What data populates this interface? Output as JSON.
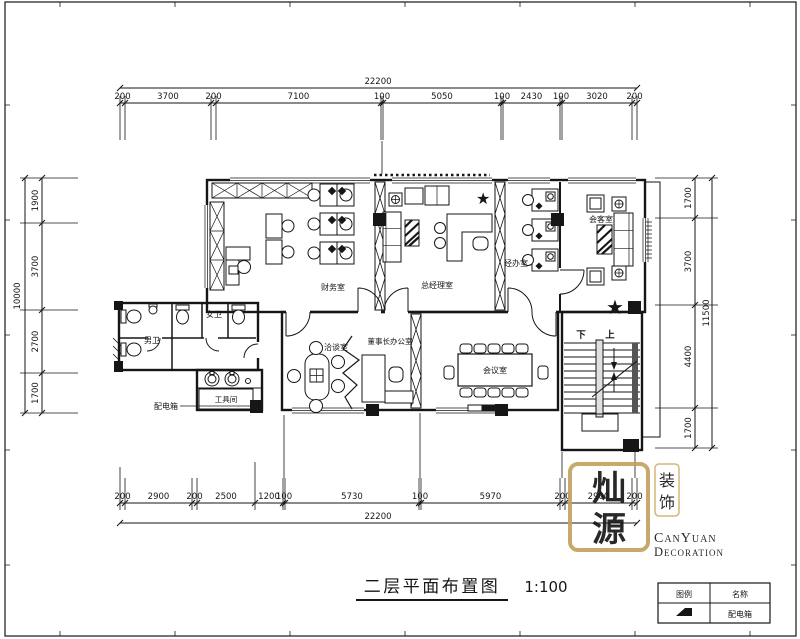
{
  "drawing": {
    "title": "二层平面布置图",
    "scale": "1:100"
  },
  "dimensions": {
    "top": {
      "total": "22200",
      "segments": [
        "200",
        "3700",
        "200",
        "7100",
        "100",
        "5050",
        "100",
        "2430",
        "100",
        "3020",
        "200"
      ]
    },
    "bottom": {
      "total": "22200",
      "segments": [
        "200",
        "2900",
        "200",
        "2500",
        "1200",
        "100",
        "5730",
        "100",
        "5970",
        "200",
        "2900",
        "200"
      ]
    },
    "left": {
      "total": "10000",
      "segments": [
        "1900",
        "3700",
        "2700",
        "1700"
      ]
    },
    "right": {
      "total": "11500",
      "segments": [
        "1700",
        "3700",
        "4400",
        "1700"
      ]
    }
  },
  "rooms": {
    "finance": "财务室",
    "general_manager": "总经理室",
    "handling_office": "经办室",
    "reception": "会客室",
    "men_toilet": "男卫",
    "women_toilet": "女卫",
    "tool_room": "工具间",
    "distribution_box": "配电箱",
    "negotiation": "洽谈室",
    "chairman_office": "董事长办公室",
    "meeting": "会议室",
    "stair_down": "下",
    "stair_up": "上"
  },
  "legend": {
    "col_symbol": "图例",
    "col_name": "名称",
    "row1_name": "配电箱"
  },
  "logo": {
    "seal_top": "灿",
    "seal_bottom": "源",
    "stamp_top": "装",
    "stamp_bottom": "饰",
    "name_en_1": "CanYuan",
    "name_en_2": "Decoration"
  },
  "icons": {
    "star": "★"
  },
  "colors": {
    "gold": "#c4a261",
    "ink": "#161616"
  }
}
